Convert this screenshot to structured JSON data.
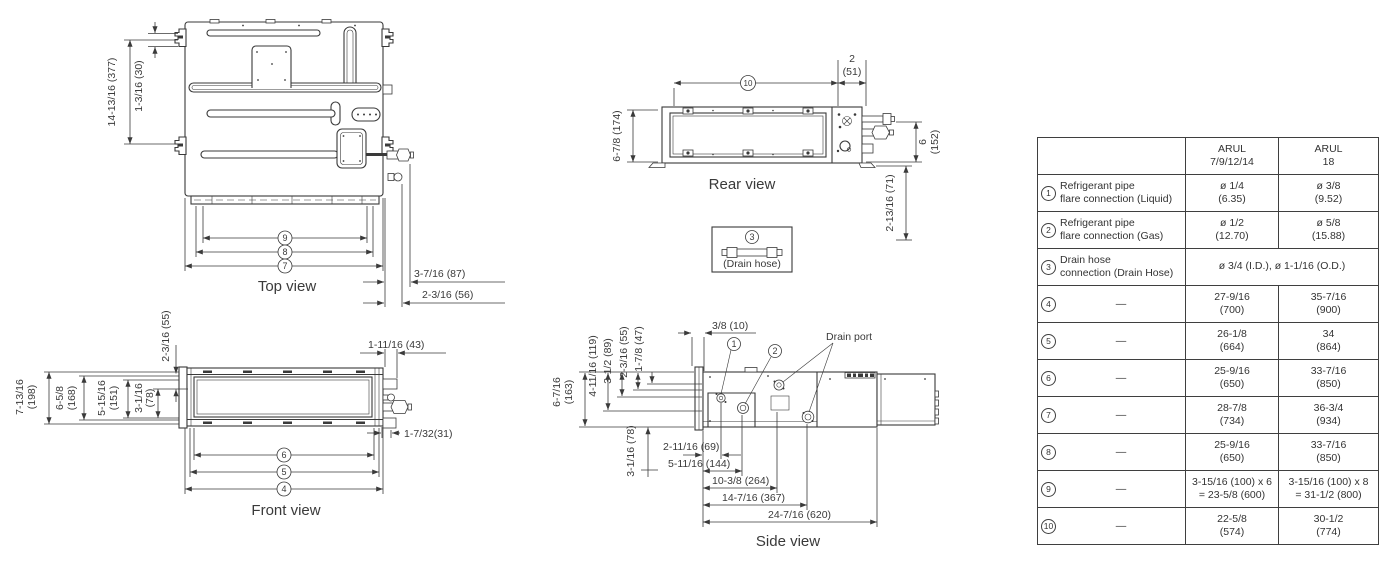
{
  "views": {
    "top": {
      "label": "Top view",
      "dim_depth": "14-13/16 (377)",
      "dim_bracket": "1-3/16 (30)",
      "dim_pipe1": "3-7/16 (87)",
      "dim_pipe2": "2-3/16 (56)",
      "ref9": "9",
      "ref8": "8",
      "ref7": "7"
    },
    "rear": {
      "label": "Rear view",
      "ref10": "10",
      "dim_edge_in": "2",
      "dim_edge_mm": "(51)",
      "dim_left": "6-7/8 (174)",
      "dim_right_in": "6",
      "dim_right_mm": "(152)",
      "dim_right_lower": "2-13/16 (71)"
    },
    "drain_hose": {
      "ref": "3",
      "label": "(Drain hose)"
    },
    "front": {
      "label": "Front view",
      "h1a": "7-13/16",
      "h1b": "(198)",
      "h2a": "6-5/8",
      "h2b": "(168)",
      "h3a": "5-15/16",
      "h3b": "(151)",
      "h4a": "3-1/16",
      "h4b": "(78)",
      "dim_top": "2-3/16 (55)",
      "dim_right_top": "1-11/16 (43)",
      "dim_right_bottom": "1-7/32(31)",
      "ref6": "6",
      "ref5": "5",
      "ref4": "4"
    },
    "side": {
      "label": "Side view",
      "drain_port": "Drain port",
      "ref1": "1",
      "ref2": "2",
      "dim_top": "3/8 (10)",
      "v1a": "6-7/16",
      "v1b": "(163)",
      "v2": "4-11/16 (119)",
      "v3": "3-1/2 (89)",
      "v4": "2-3/16 (55)",
      "v5": "1-7/8 (47)",
      "v6": "3-1/16 (78)",
      "b1": "2-11/16 (69)",
      "b2": "5-11/16 (144)",
      "b3": "10-3/8 (264)",
      "b4": "14-7/16 (367)",
      "b5": "24-7/16 (620)"
    }
  },
  "table": {
    "col1_header": "ARUL\n7/9/12/14",
    "col2_header": "ARUL\n18",
    "rows": [
      {
        "num": "1",
        "desc": "Refrigerant pipe\nflare connection (Liquid)",
        "v1": "ø 1/4\n(6.35)",
        "v2": "ø 3/8\n(9.52)"
      },
      {
        "num": "2",
        "desc": "Refrigerant pipe\nflare connection (Gas)",
        "v1": "ø 1/2\n(12.70)",
        "v2": "ø 5/8\n(15.88)"
      },
      {
        "num": "3",
        "desc": "Drain hose\nconnection (Drain Hose)",
        "v1": "ø 3/4 (I.D.), ø 1-1/16 (O.D.)"
      },
      {
        "num": "4",
        "desc": "—",
        "v1": "27-9/16\n(700)",
        "v2": "35-7/16\n(900)"
      },
      {
        "num": "5",
        "desc": "—",
        "v1": "26-1/8\n(664)",
        "v2": "34\n(864)"
      },
      {
        "num": "6",
        "desc": "—",
        "v1": "25-9/16\n(650)",
        "v2": "33-7/16\n(850)"
      },
      {
        "num": "7",
        "desc": "—",
        "v1": "28-7/8\n(734)",
        "v2": "36-3/4\n(934)"
      },
      {
        "num": "8",
        "desc": "—",
        "v1": "25-9/16\n(650)",
        "v2": "33-7/16\n(850)"
      },
      {
        "num": "9",
        "desc": "—",
        "v1": "3-15/16 (100) x 6\n= 23-5/8 (600)",
        "v2": "3-15/16 (100) x 8\n= 31-1/2 (800)"
      },
      {
        "num": "10",
        "desc": "—",
        "v1": "22-5/8\n(574)",
        "v2": "30-1/2\n(774)"
      }
    ]
  }
}
